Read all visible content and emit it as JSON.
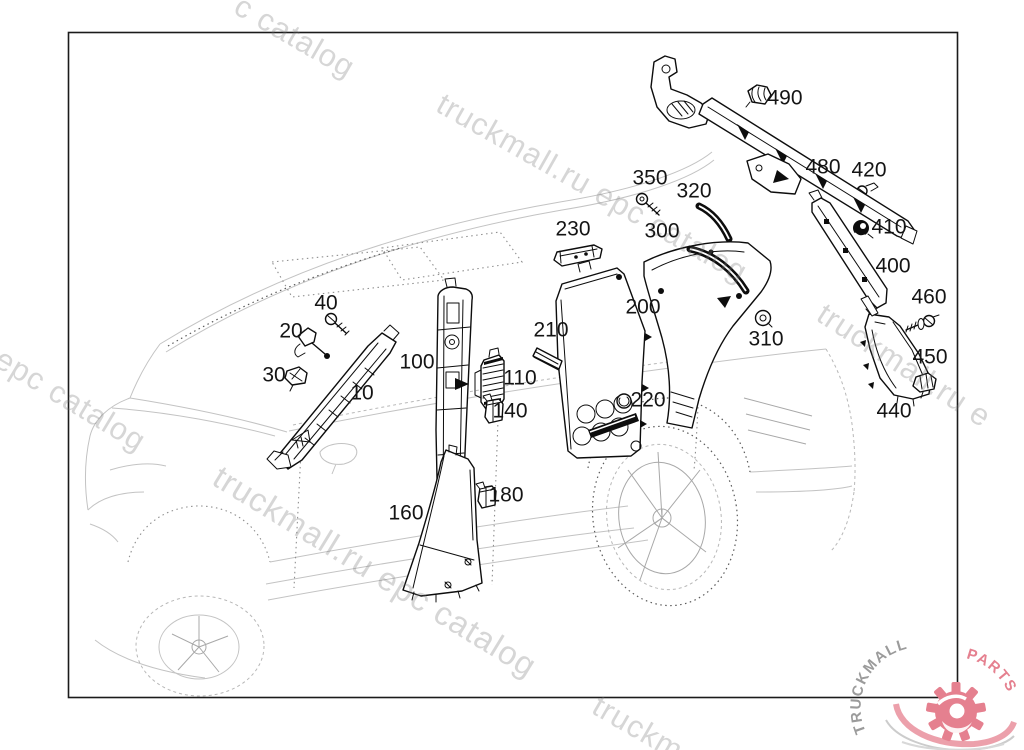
{
  "watermark_text": "truckmall.ru epc catalog",
  "watermarks": [
    {
      "text": "c catalog",
      "x": 246,
      "y": -12,
      "rot": 30,
      "size": 31
    },
    {
      "text": "truckmall.ru epc catalog",
      "x": 448,
      "y": 86,
      "rot": 29.5,
      "size": 31
    },
    {
      "text": "l epc catalog",
      "x": -8,
      "y": 332,
      "rot": 31,
      "size": 31
    },
    {
      "text": "truckmall.ru epc catalog",
      "x": 226,
      "y": 458,
      "rot": 31.5,
      "size": 33
    },
    {
      "text": "truckmall.ru e",
      "x": 830,
      "y": 296,
      "rot": 33,
      "size": 31
    },
    {
      "text": "truckm",
      "x": 604,
      "y": 688,
      "rot": 30,
      "size": 31
    }
  ],
  "parts": [
    {
      "label": "10",
      "x": 362,
      "y": 393
    },
    {
      "label": "20",
      "x": 291,
      "y": 331
    },
    {
      "label": "30",
      "x": 274,
      "y": 375
    },
    {
      "label": "40",
      "x": 326,
      "y": 303
    },
    {
      "label": "100",
      "x": 417,
      "y": 362
    },
    {
      "label": "110",
      "x": 520,
      "y": 378
    },
    {
      "label": "140",
      "x": 510,
      "y": 411
    },
    {
      "label": "160",
      "x": 406,
      "y": 513
    },
    {
      "label": "180",
      "x": 506,
      "y": 495
    },
    {
      "label": "200",
      "x": 643,
      "y": 307
    },
    {
      "label": "210",
      "x": 551,
      "y": 330
    },
    {
      "label": "220",
      "x": 648,
      "y": 400
    },
    {
      "label": "230",
      "x": 573,
      "y": 229
    },
    {
      "label": "300",
      "x": 662,
      "y": 231
    },
    {
      "label": "310",
      "x": 766,
      "y": 339
    },
    {
      "label": "320",
      "x": 694,
      "y": 191
    },
    {
      "label": "350",
      "x": 650,
      "y": 178
    },
    {
      "label": "400",
      "x": 893,
      "y": 266
    },
    {
      "label": "410",
      "x": 889,
      "y": 227
    },
    {
      "label": "420",
      "x": 869,
      "y": 170
    },
    {
      "label": "440",
      "x": 894,
      "y": 411
    },
    {
      "label": "450",
      "x": 930,
      "y": 357
    },
    {
      "label": "460",
      "x": 929,
      "y": 297
    },
    {
      "label": "480",
      "x": 823,
      "y": 167
    },
    {
      "label": "490",
      "x": 785,
      "y": 98
    }
  ],
  "logo": {
    "brand": "TRUCKMALL",
    "suffix": "PARTS",
    "brand_color": "#9b9b9b",
    "accent_color": "#e5808f"
  }
}
